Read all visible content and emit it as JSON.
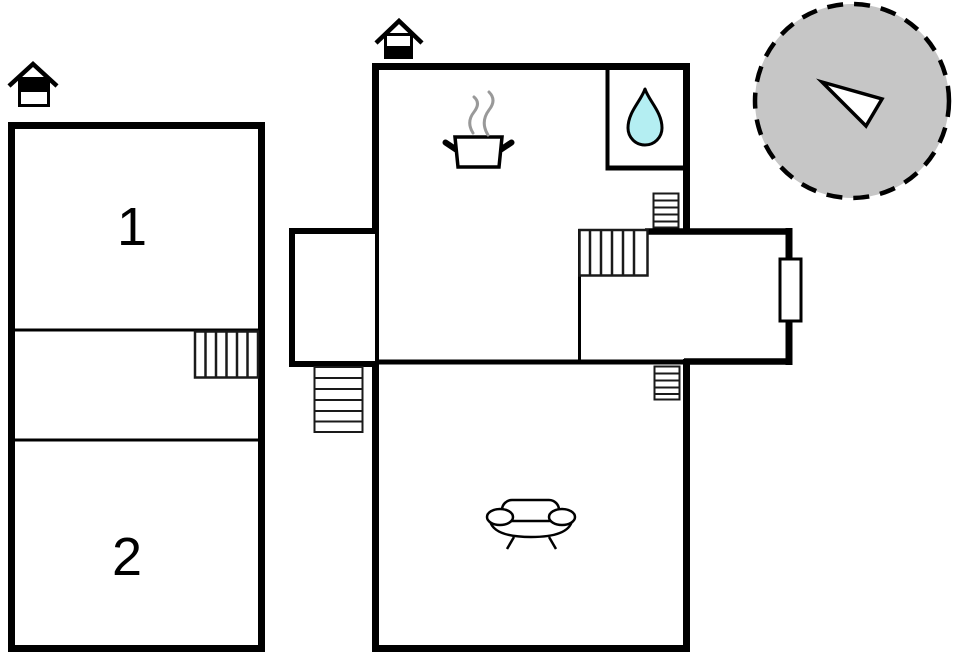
{
  "plan": {
    "type": "floor-plan",
    "left_building": {
      "room1_label": "1",
      "room2_label": "2",
      "level_icon": "house-level-icon-top-filled"
    },
    "main_building": {
      "level_icon": "house-level-icon-bottom-filled",
      "kitchen_icon": "cooking-pot-icon",
      "bathroom_icon": "water-drop-icon",
      "living_room_icon": "sofa-icon",
      "stairs_icons": [
        "staircase",
        "entrance-steps",
        "ladder-upper",
        "ladder-lower",
        "hall-staircase"
      ],
      "door_icon": "door-opening"
    },
    "compass_icon": "north-arrow-icon"
  },
  "colors": {
    "wall": "#000000",
    "background": "#ffffff",
    "water_drop_fill": "#b4eef2",
    "compass_circle_fill": "#c6c6c6",
    "compass_arrow_fill": "#ffffff",
    "steam": "#999999"
  }
}
